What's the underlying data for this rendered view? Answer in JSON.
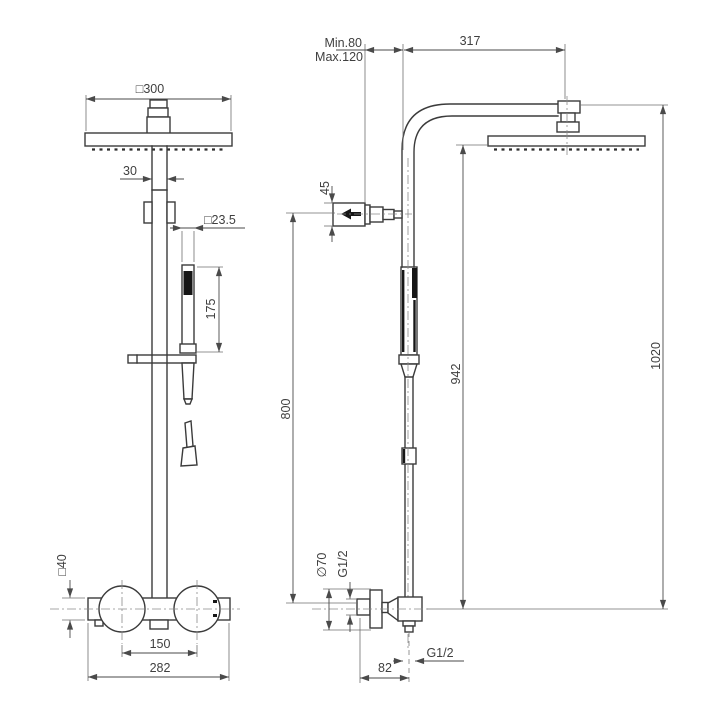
{
  "style": {
    "background": "#ffffff",
    "line_color": "#3b3b3b",
    "dimension_text_color": "#3f3f3f"
  },
  "front_view": {
    "dim_head_width": "□300",
    "dim_pipe_width": "30",
    "dim_hand_shower_width": "□23.5",
    "dim_hand_shower_length": "175",
    "dim_valve_body_height": "□40",
    "dim_handle_centers": "150",
    "dim_valve_width": "282"
  },
  "side_view": {
    "dim_wall_distance_min": "Min.80",
    "dim_wall_distance_max": "Max.120",
    "dim_arm_projection": "317",
    "dim_bracket_height": "45",
    "dim_bracket_to_valve": "800",
    "dim_head_to_valve": "942",
    "dim_overall_height": "1020",
    "dim_escutcheon_diameter": "∅70",
    "dim_inlet_thread": "G1/2",
    "dim_outlet_thread": "G1/2",
    "dim_valve_projection": "82"
  }
}
